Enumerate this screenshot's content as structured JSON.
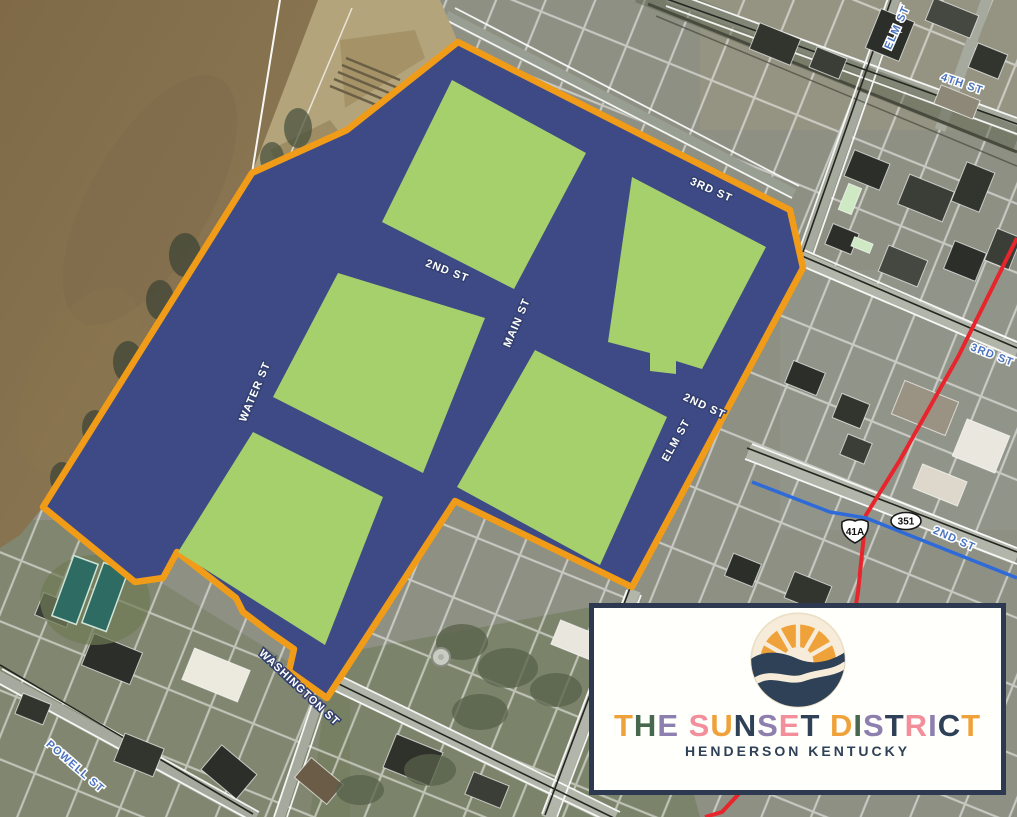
{
  "map": {
    "district": {
      "name": "The Sunset District boundary",
      "colors": {
        "boundary": "#F19C18",
        "streets_fill": "#3E4A85",
        "blocks_fill": "#A6D06C"
      },
      "street_labels": [
        {
          "id": "3rd-st",
          "text": "3RD ST"
        },
        {
          "id": "2nd-st-upper",
          "text": "2ND ST"
        },
        {
          "id": "2nd-st-lower",
          "text": "2ND ST"
        },
        {
          "id": "main-st",
          "text": "MAIN ST"
        },
        {
          "id": "water-st",
          "text": "WATER ST"
        },
        {
          "id": "elm-st",
          "text": "ELM ST"
        },
        {
          "id": "washington-st",
          "text": "WASHINGTON ST"
        }
      ]
    },
    "city_labels": [
      {
        "id": "elm-st-north",
        "text": "ELM ST"
      },
      {
        "id": "4th-st",
        "text": "4TH ST"
      },
      {
        "id": "3rd-st-east",
        "text": "3RD ST"
      },
      {
        "id": "2nd-st-east",
        "text": "2ND ST"
      },
      {
        "id": "powell-st",
        "text": "POWELL ST"
      }
    ],
    "route_markers": [
      {
        "id": "us-41a",
        "text": "41A"
      },
      {
        "id": "ky-351",
        "text": "351"
      }
    ],
    "route_colors": {
      "us41a": "#E8242C",
      "ky351": "#2F6BD8"
    },
    "terrain_colors": {
      "river": "#8A7351",
      "park": "#B3A47C",
      "city_base": "#8D9083"
    }
  },
  "logo": {
    "title": "THE SUNSET DISTRICT",
    "subtitle": "HENDERSON KENTUCKY",
    "title_letters": [
      {
        "ch": "T",
        "color": "#F0A23A"
      },
      {
        "ch": "H",
        "color": "#47684E"
      },
      {
        "ch": "E",
        "color": "#8D7FAE"
      },
      {
        "ch": " ",
        "color": "#000000"
      },
      {
        "ch": "S",
        "color": "#F28F9B"
      },
      {
        "ch": "U",
        "color": "#F0A23A"
      },
      {
        "ch": "N",
        "color": "#2E4157"
      },
      {
        "ch": "S",
        "color": "#8D7FAE"
      },
      {
        "ch": "E",
        "color": "#F28F9B"
      },
      {
        "ch": "T",
        "color": "#2E4157"
      },
      {
        "ch": " ",
        "color": "#000000"
      },
      {
        "ch": "D",
        "color": "#F0A23A"
      },
      {
        "ch": "I",
        "color": "#47684E"
      },
      {
        "ch": "S",
        "color": "#8D7FAE"
      },
      {
        "ch": "T",
        "color": "#2E4157"
      },
      {
        "ch": "R",
        "color": "#F28F9B"
      },
      {
        "ch": "I",
        "color": "#8D7FAE"
      },
      {
        "ch": "C",
        "color": "#2E4157"
      },
      {
        "ch": "T",
        "color": "#F0A23A"
      }
    ],
    "palette": {
      "orange": "#F0A23A",
      "navy": "#2E4157",
      "green": "#47684E",
      "purple": "#8D7FAE",
      "pink": "#F28F9B",
      "cream": "#F7ECD9"
    }
  }
}
